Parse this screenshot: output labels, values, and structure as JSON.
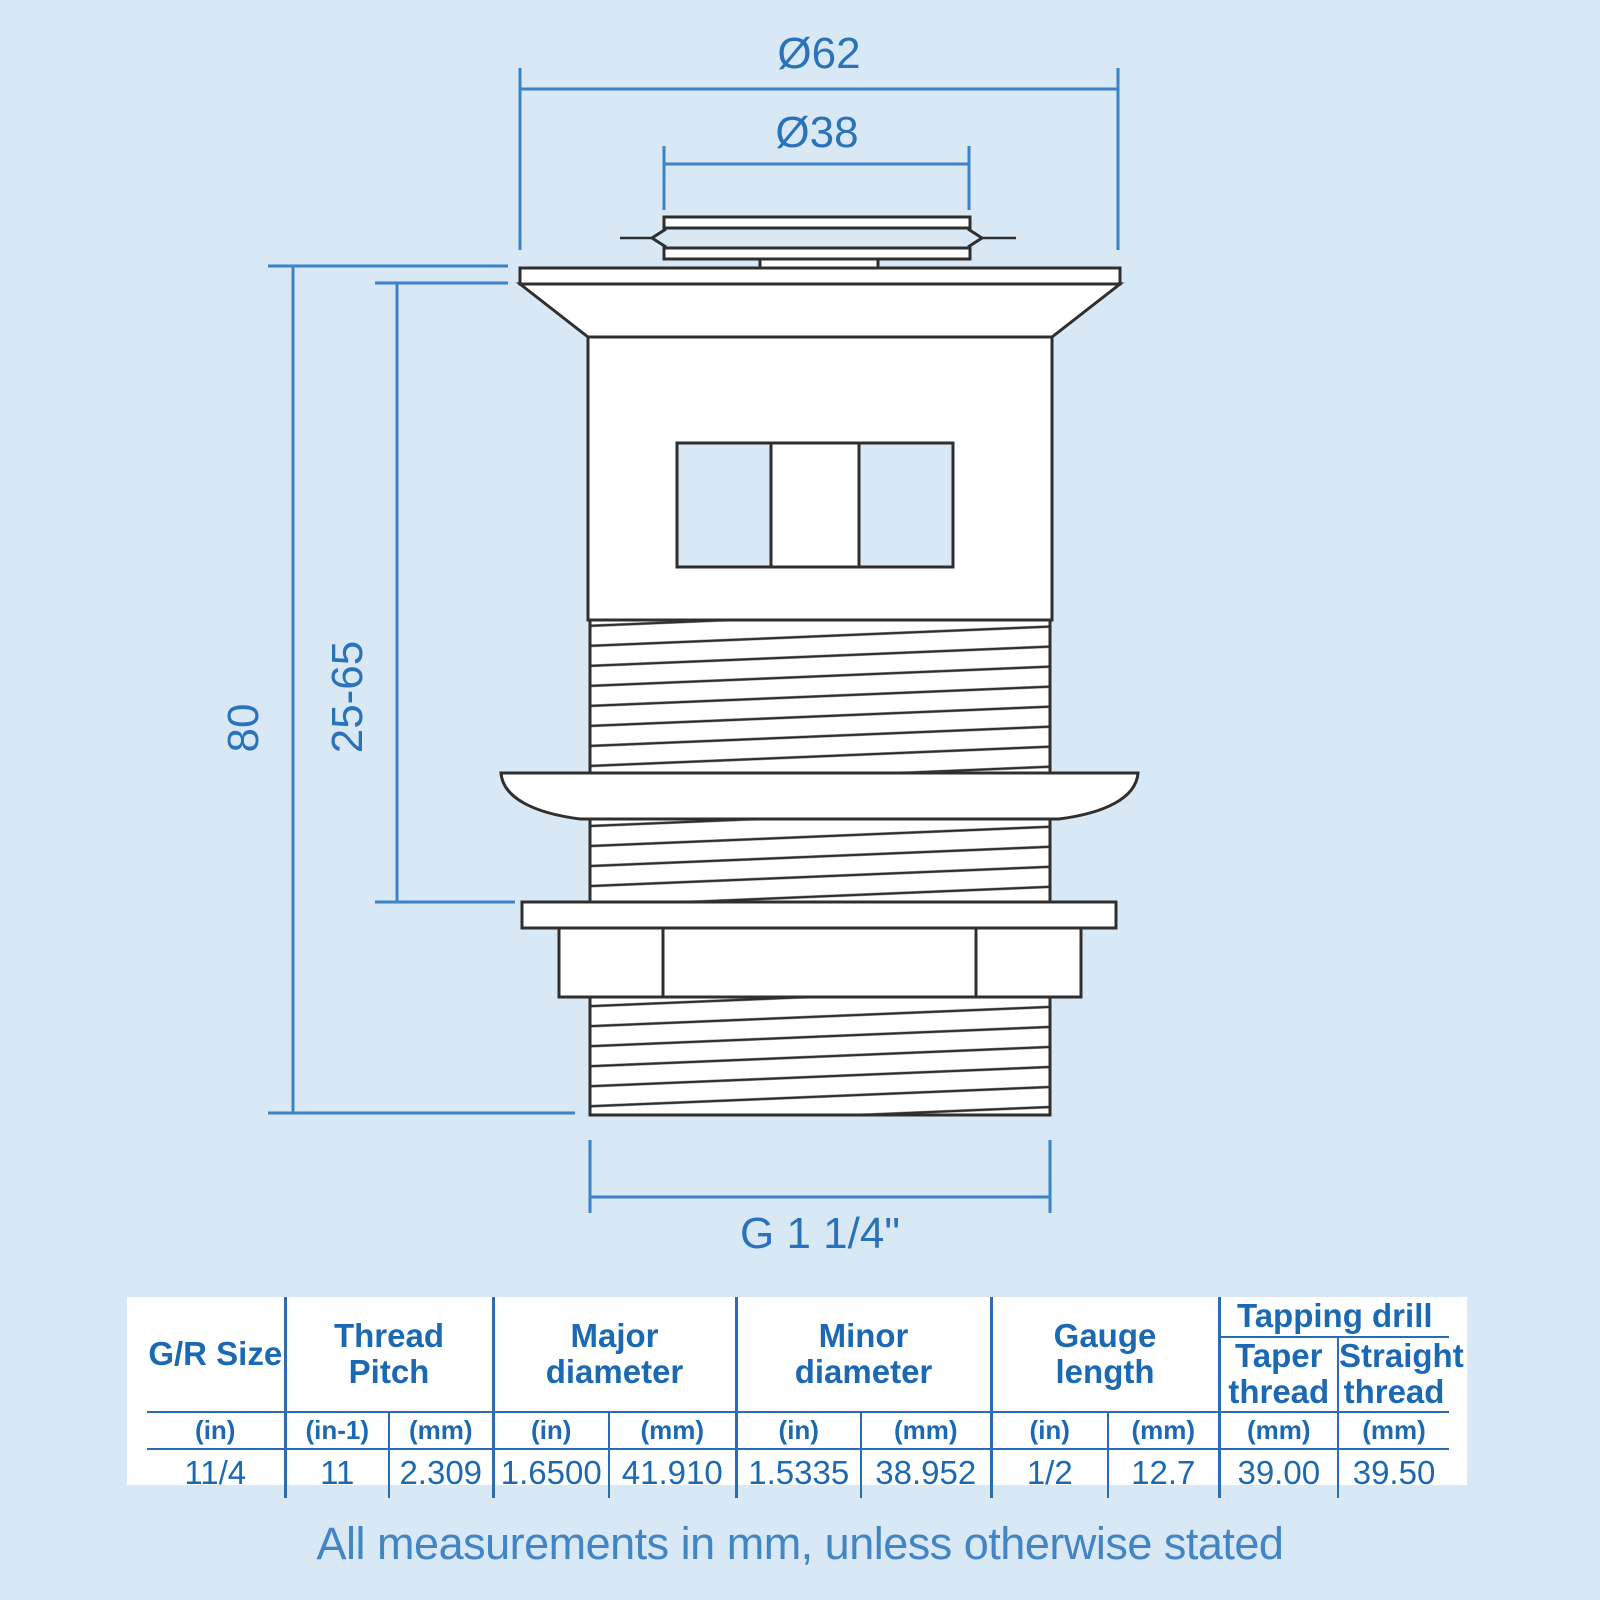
{
  "colors": {
    "background": "#d9e8f5",
    "table_line_blue": "#2a6db5",
    "table_text_blue": "#1c69b3",
    "dimension_line_blue": "#3a85c8",
    "dimension_text_blue": "#2a72ba",
    "drawing_stroke": "#2f2f2f",
    "drawing_fill": "#ffffff"
  },
  "dims": {
    "outer_diameter": "Ø62",
    "inner_diameter": "Ø38",
    "overall_height": "80",
    "clamp_range": "25-65",
    "thread_size": "G 1 1/4\""
  },
  "table": {
    "headers": {
      "gr_size": "G/R Size",
      "thread_pitch": "Thread\nPitch",
      "major_diameter": "Major\ndiameter",
      "minor_diameter": "Minor\ndiameter",
      "gauge_length": "Gauge\nlength",
      "tapping_drill": "Tapping drill",
      "taper_thread": "Taper\nthread",
      "straight_thread": "Straight\nthread"
    },
    "units": [
      "(in)",
      "(in-1)",
      "(mm)",
      "(in)",
      "(mm)",
      "(in)",
      "(mm)",
      "(in)",
      "(mm)",
      "(mm)",
      "(mm)"
    ],
    "values": [
      "11/4",
      "11",
      "2.309",
      "1.6500",
      "41.910",
      "1.5335",
      "38.952",
      "1/2",
      "12.7",
      "39.00",
      "39.50"
    ]
  },
  "footer": {
    "note": "All measurements in mm, unless otherwise stated"
  }
}
